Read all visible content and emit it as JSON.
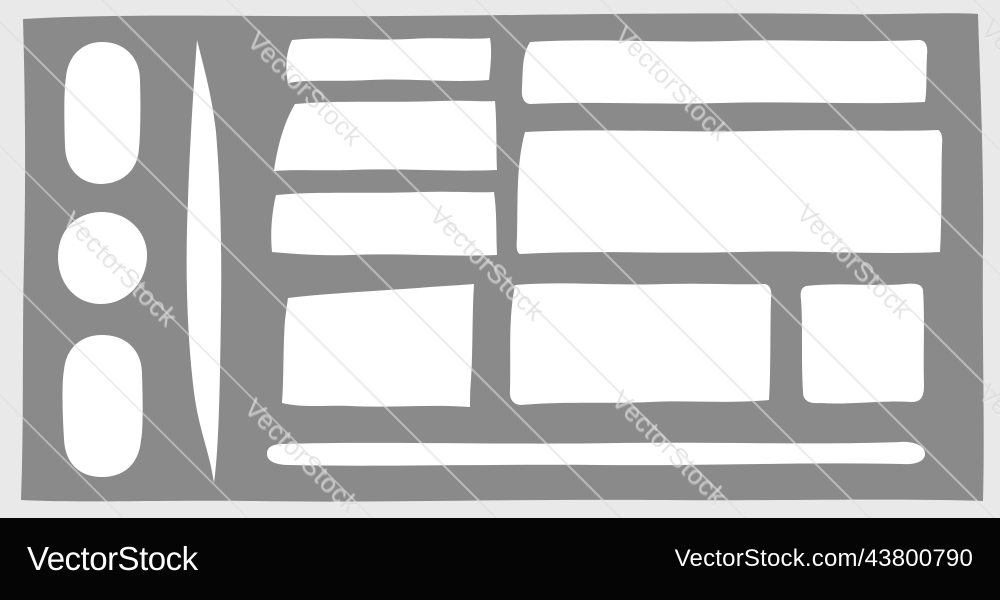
{
  "watermark": {
    "text": "VectorStock"
  },
  "footer": {
    "brand": "VectorStock",
    "url": "VectorStock.com/43800790"
  },
  "colors": {
    "background": "#e9e9e9",
    "canvas_gray": "#8a8a8a",
    "shape_white": "#ffffff",
    "footer_bg": "#050505",
    "footer_text": "#ffffff"
  }
}
